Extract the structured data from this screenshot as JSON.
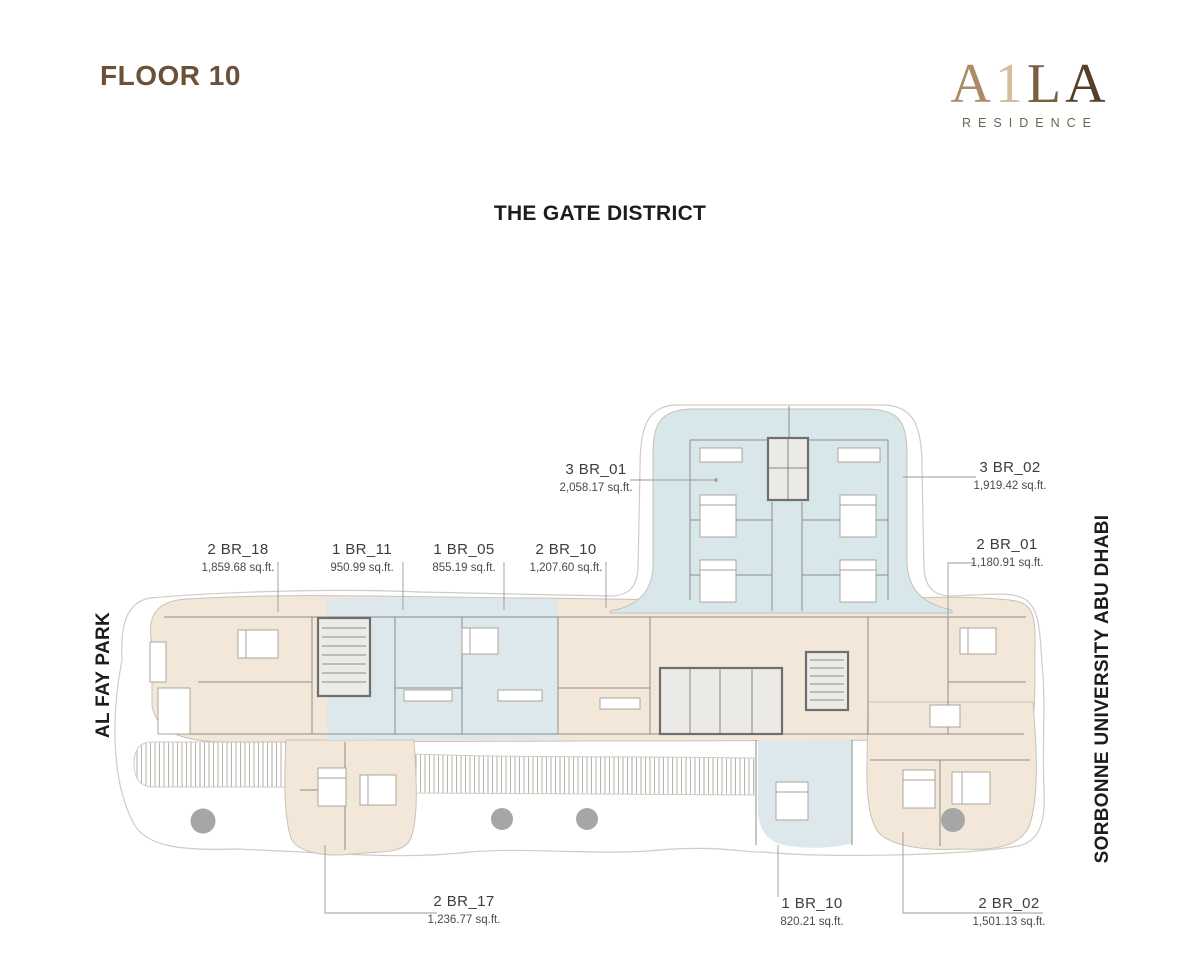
{
  "page": {
    "floor_label": "FLOOR 10",
    "heading": "THE GATE DISTRICT",
    "landmark_left": "AL FAY PARK",
    "landmark_right": "SORBONNE UNIVERSITY ABU DHABI"
  },
  "brand": {
    "letters": [
      "A",
      "1",
      "L",
      "A"
    ],
    "subtitle": "RESIDENCE"
  },
  "units": [
    {
      "id": "3br01",
      "name": "3 BR_01",
      "area": "2,058.17 sq.ft."
    },
    {
      "id": "3br02",
      "name": "3 BR_02",
      "area": "1,919.42 sq.ft."
    },
    {
      "id": "2br18",
      "name": "2 BR_18",
      "area": "1,859.68 sq.ft."
    },
    {
      "id": "1br11",
      "name": "1 BR_11",
      "area": "950.99 sq.ft."
    },
    {
      "id": "1br05",
      "name": "1 BR_05",
      "area": "855.19 sq.ft."
    },
    {
      "id": "2br10",
      "name": "2 BR_10",
      "area": "1,207.60 sq.ft."
    },
    {
      "id": "2br01",
      "name": "2 BR_01",
      "area": "1,180.91 sq.ft."
    },
    {
      "id": "2br17",
      "name": "2 BR_17",
      "area": "1,236.77 sq.ft."
    },
    {
      "id": "1br10",
      "name": "1 BR_10",
      "area": "820.21 sq.ft."
    },
    {
      "id": "2br02",
      "name": "2 BR_02",
      "area": "1,501.13 sq.ft."
    }
  ],
  "colors": {
    "cream": "#f2e7d9",
    "blue": "#dce8ec",
    "wing_blue": "#d8e7ea",
    "edge": "#c9c2b8",
    "terrace": "#cfccc6",
    "hatch": "#b7b2aa",
    "wall": "#8d8d8d",
    "wall_dark": "#6e6e6e",
    "furn": "#a59e94",
    "dot": "#a6a6a6",
    "leader": "#9a9a9a",
    "ink": "#1c1c1c",
    "label": "#3d3d3d",
    "label_sub": "#4a4a4a",
    "brown": "#6a5138",
    "logo_a1": "#a98c66",
    "logo_n1": "#d3bd9b",
    "logo_l": "#7a5f41",
    "logo_a2": "#553f2b",
    "logo_sub": "#6f6250"
  }
}
